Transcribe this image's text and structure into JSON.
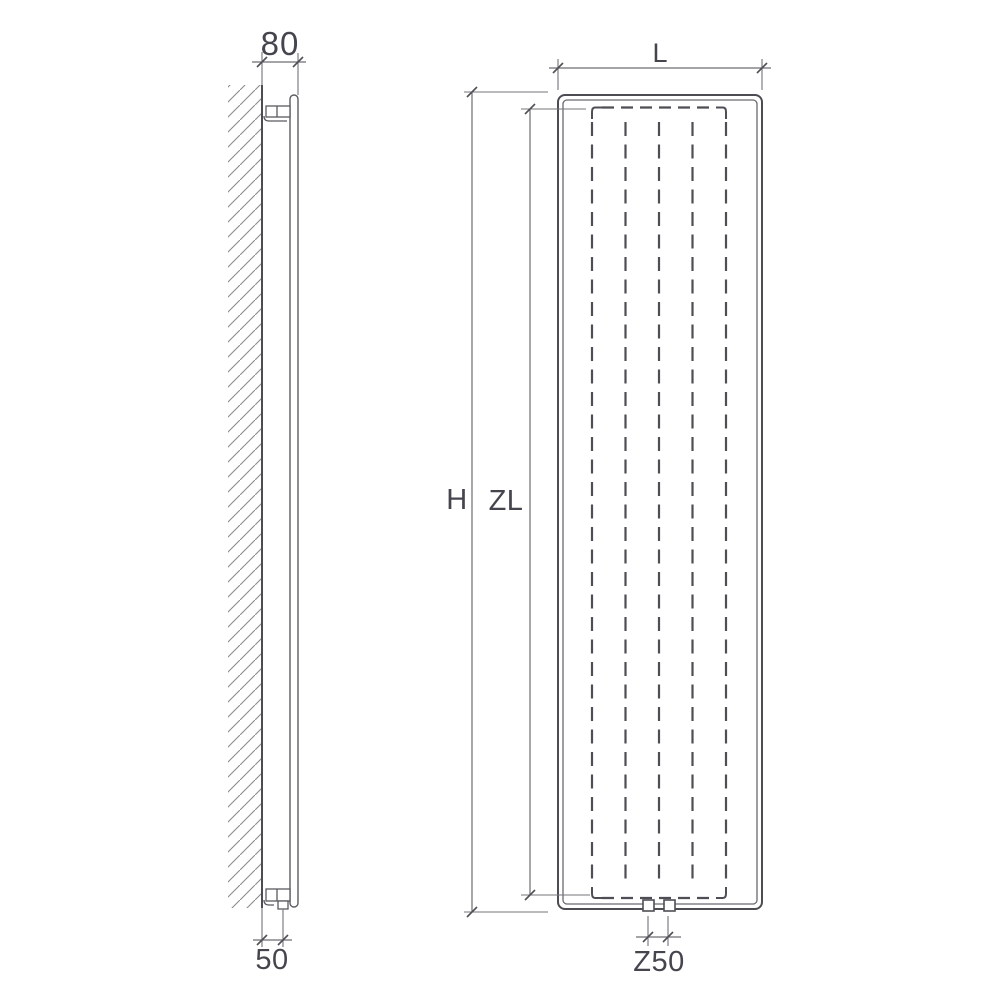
{
  "diagram": {
    "title": "Vertical radiator dimension drawing",
    "views": {
      "side": "side-section-view",
      "front": "front-elevation-view"
    },
    "colors": {
      "background": "#ffffff",
      "line": "#55555b",
      "text": "#45454e"
    }
  },
  "labels": {
    "depth": "80",
    "bottom_offset": "50",
    "length": "L",
    "height": "H",
    "inner_height": "ZL",
    "connection_spacing": "Z50"
  }
}
